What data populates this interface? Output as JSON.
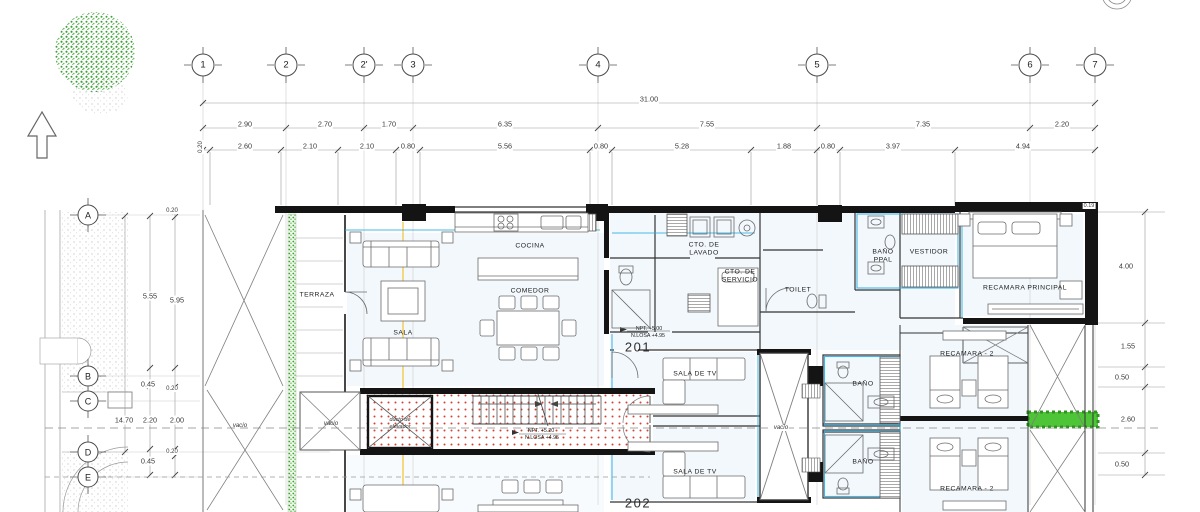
{
  "drawing": {
    "grid_columns": [
      "1",
      "2",
      "2'",
      "3",
      "4",
      "5",
      "6",
      "7"
    ],
    "grid_rows": [
      "A",
      "B",
      "C",
      "D",
      "E"
    ],
    "dims": {
      "overall": "31.00",
      "spacing": [
        "2.90",
        "2.70",
        "1.70",
        "6.35",
        "7.55",
        "7.35",
        "2.20"
      ],
      "detail": [
        "0.20",
        "2.60",
        "2.10",
        "2.10",
        "0.80",
        "5.56",
        "0.80",
        "5.28",
        "1.88",
        "0.80",
        "3.97",
        "4.94"
      ],
      "left_outer": "14.70",
      "left_mid": [
        "5.55",
        "0.45",
        "2.20",
        "0.45"
      ],
      "left_inner": [
        "0.20",
        "5.95",
        "0.20",
        "2.00",
        "0.20"
      ],
      "right": [
        "0.19",
        "4.00",
        "1.55",
        "0.50",
        "2.60",
        "0.50"
      ]
    },
    "rooms": {
      "terraza": "TERRAZA",
      "sala": "SALA",
      "cocina": "COCINA",
      "comedor": "COMEDOR",
      "cto_lavado": "CTO. DE LAVADO",
      "cto_servicio": "CTO. DE SERVICIO",
      "toilet": "TOILET",
      "bano_ppal": "BAÑO PPAL",
      "vestidor": "VESTIDOR",
      "recamara_principal": "RECAMARA PRINCIPAL",
      "sala_tv": "SALA DE TV",
      "bano": "BAÑO",
      "recamara_2": "RECAMARA - 2",
      "vacio": "vacío",
      "ducto_elevador": "ducto de elevador"
    },
    "units": {
      "upper": "201",
      "lower": "202"
    },
    "levels": {
      "npt_unit": "NPT. +5.00",
      "losa_unit": "N.LOSA +4.95",
      "npt_stair": "NPT. +5.20",
      "losa_stair": "N.LOSA +4.95"
    },
    "colors": {
      "accent_cyan": "#29abe2",
      "hatch_red": "#d6402f",
      "planter_green": "#3aa32c",
      "axis_highlight": "#f2b705",
      "wall": "#141414"
    },
    "icons": {
      "north_arrow": "north-arrow",
      "tree": "tree-symbol"
    }
  }
}
